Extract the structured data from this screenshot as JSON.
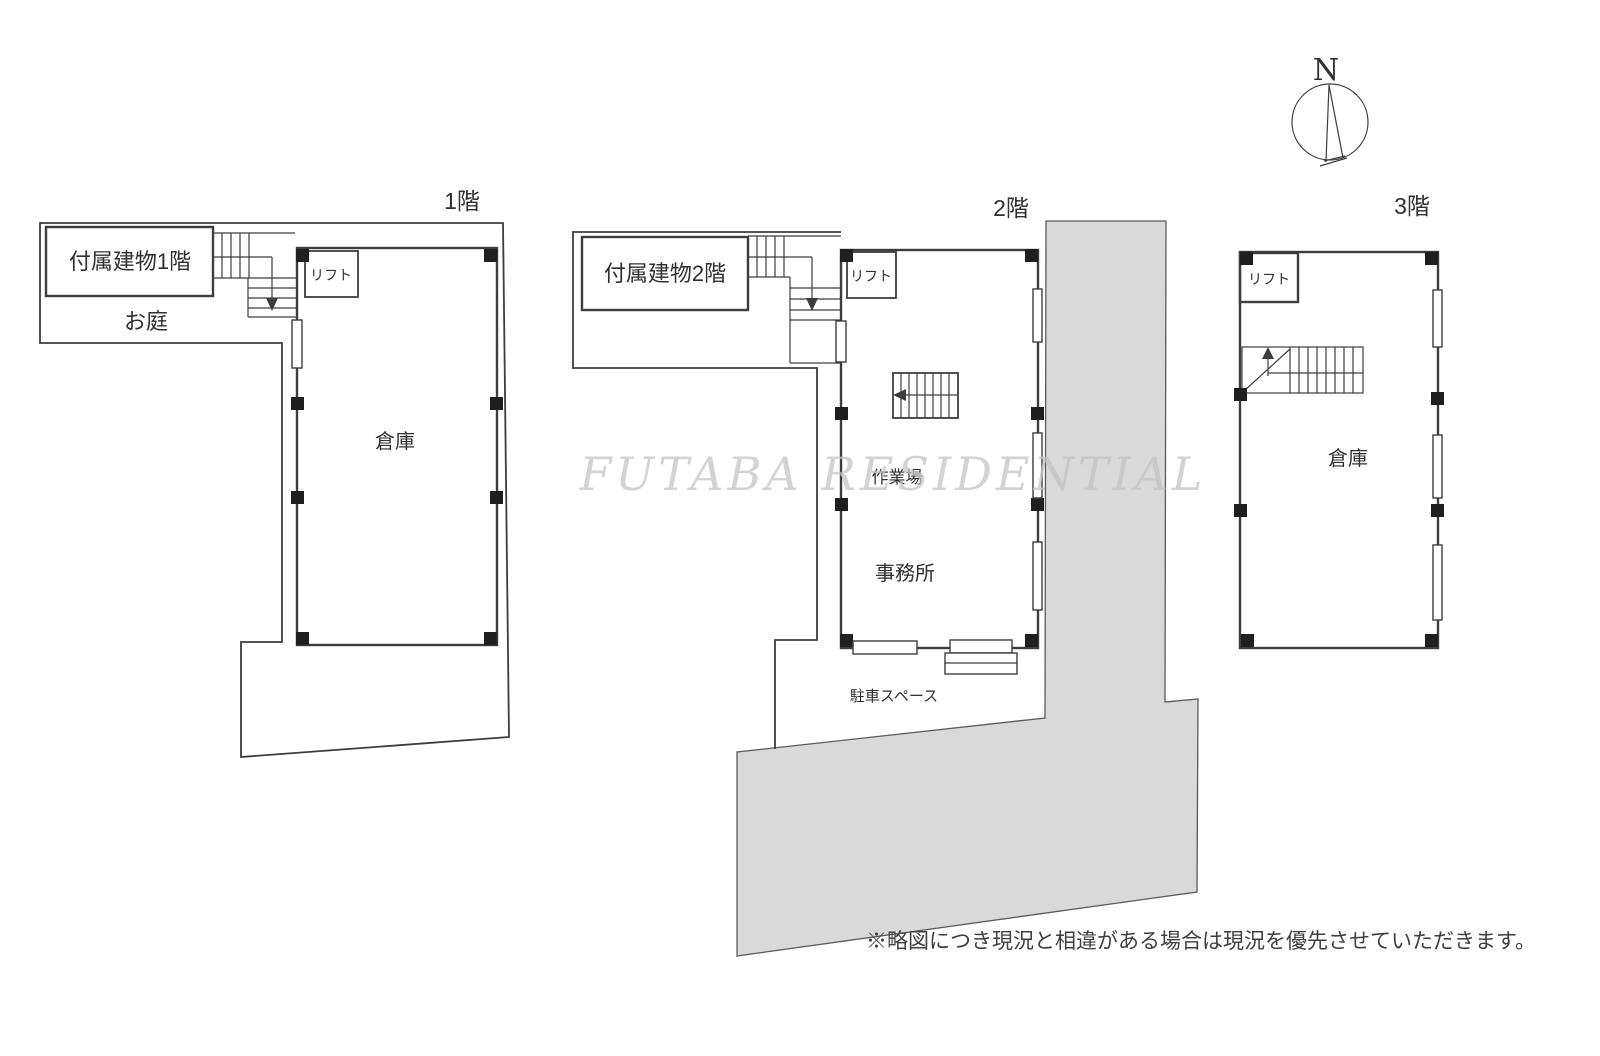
{
  "colors": {
    "line": "#3d3d3d",
    "pillar": "#1f1f1f",
    "road": "#d9d9d9",
    "roadline": "#5a5a5a",
    "ink": "#2f2f2f",
    "wm": "#c3c3c3",
    "note": "#3f3f3f",
    "bg": "#ffffff"
  },
  "compass": {
    "letter": "N"
  },
  "watermark": {
    "text": "FUTABA RESIDENTIAL"
  },
  "note": {
    "text": "※略図につき現況と相違がある場合は現況を優先させていただきます。"
  },
  "floors": {
    "f1": {
      "title": "1階",
      "annex": "付属建物1階",
      "garden": "お庭",
      "lift": "リフト",
      "warehouse": "倉庫"
    },
    "f2": {
      "title": "2階",
      "annex": "付属建物2階",
      "lift": "リフト",
      "workshop": "作業場",
      "office": "事務所",
      "parking": "駐車スペース"
    },
    "f3": {
      "title": "3階",
      "lift": "リフト",
      "warehouse": "倉庫"
    }
  }
}
